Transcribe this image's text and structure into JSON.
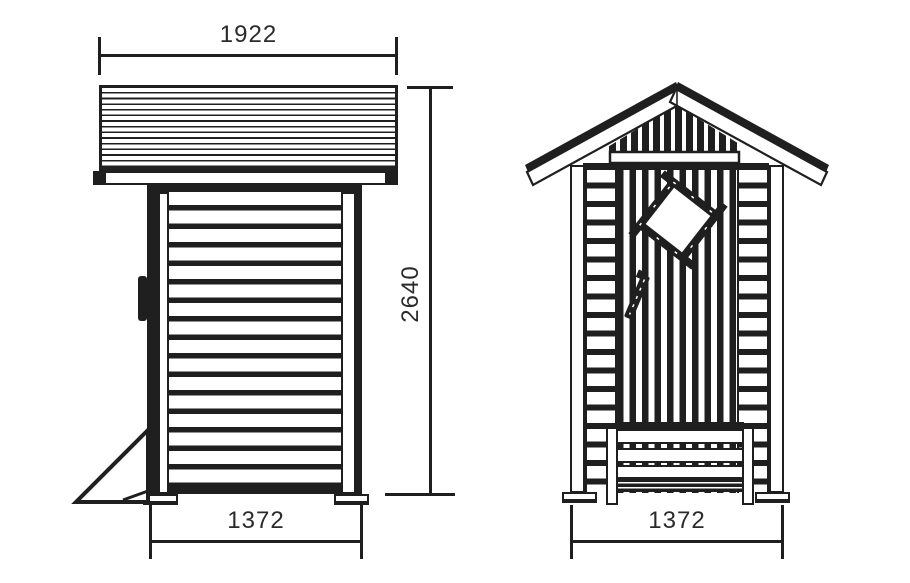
{
  "diagram": {
    "side_view": {
      "roof_width": "1922",
      "height": "2640",
      "base_width": "1372"
    },
    "front_view": {
      "base_width": "1372"
    }
  },
  "colors": {
    "line": "#1f1f1f",
    "background": "#ffffff",
    "dimension_text": "#2b2b2b"
  }
}
